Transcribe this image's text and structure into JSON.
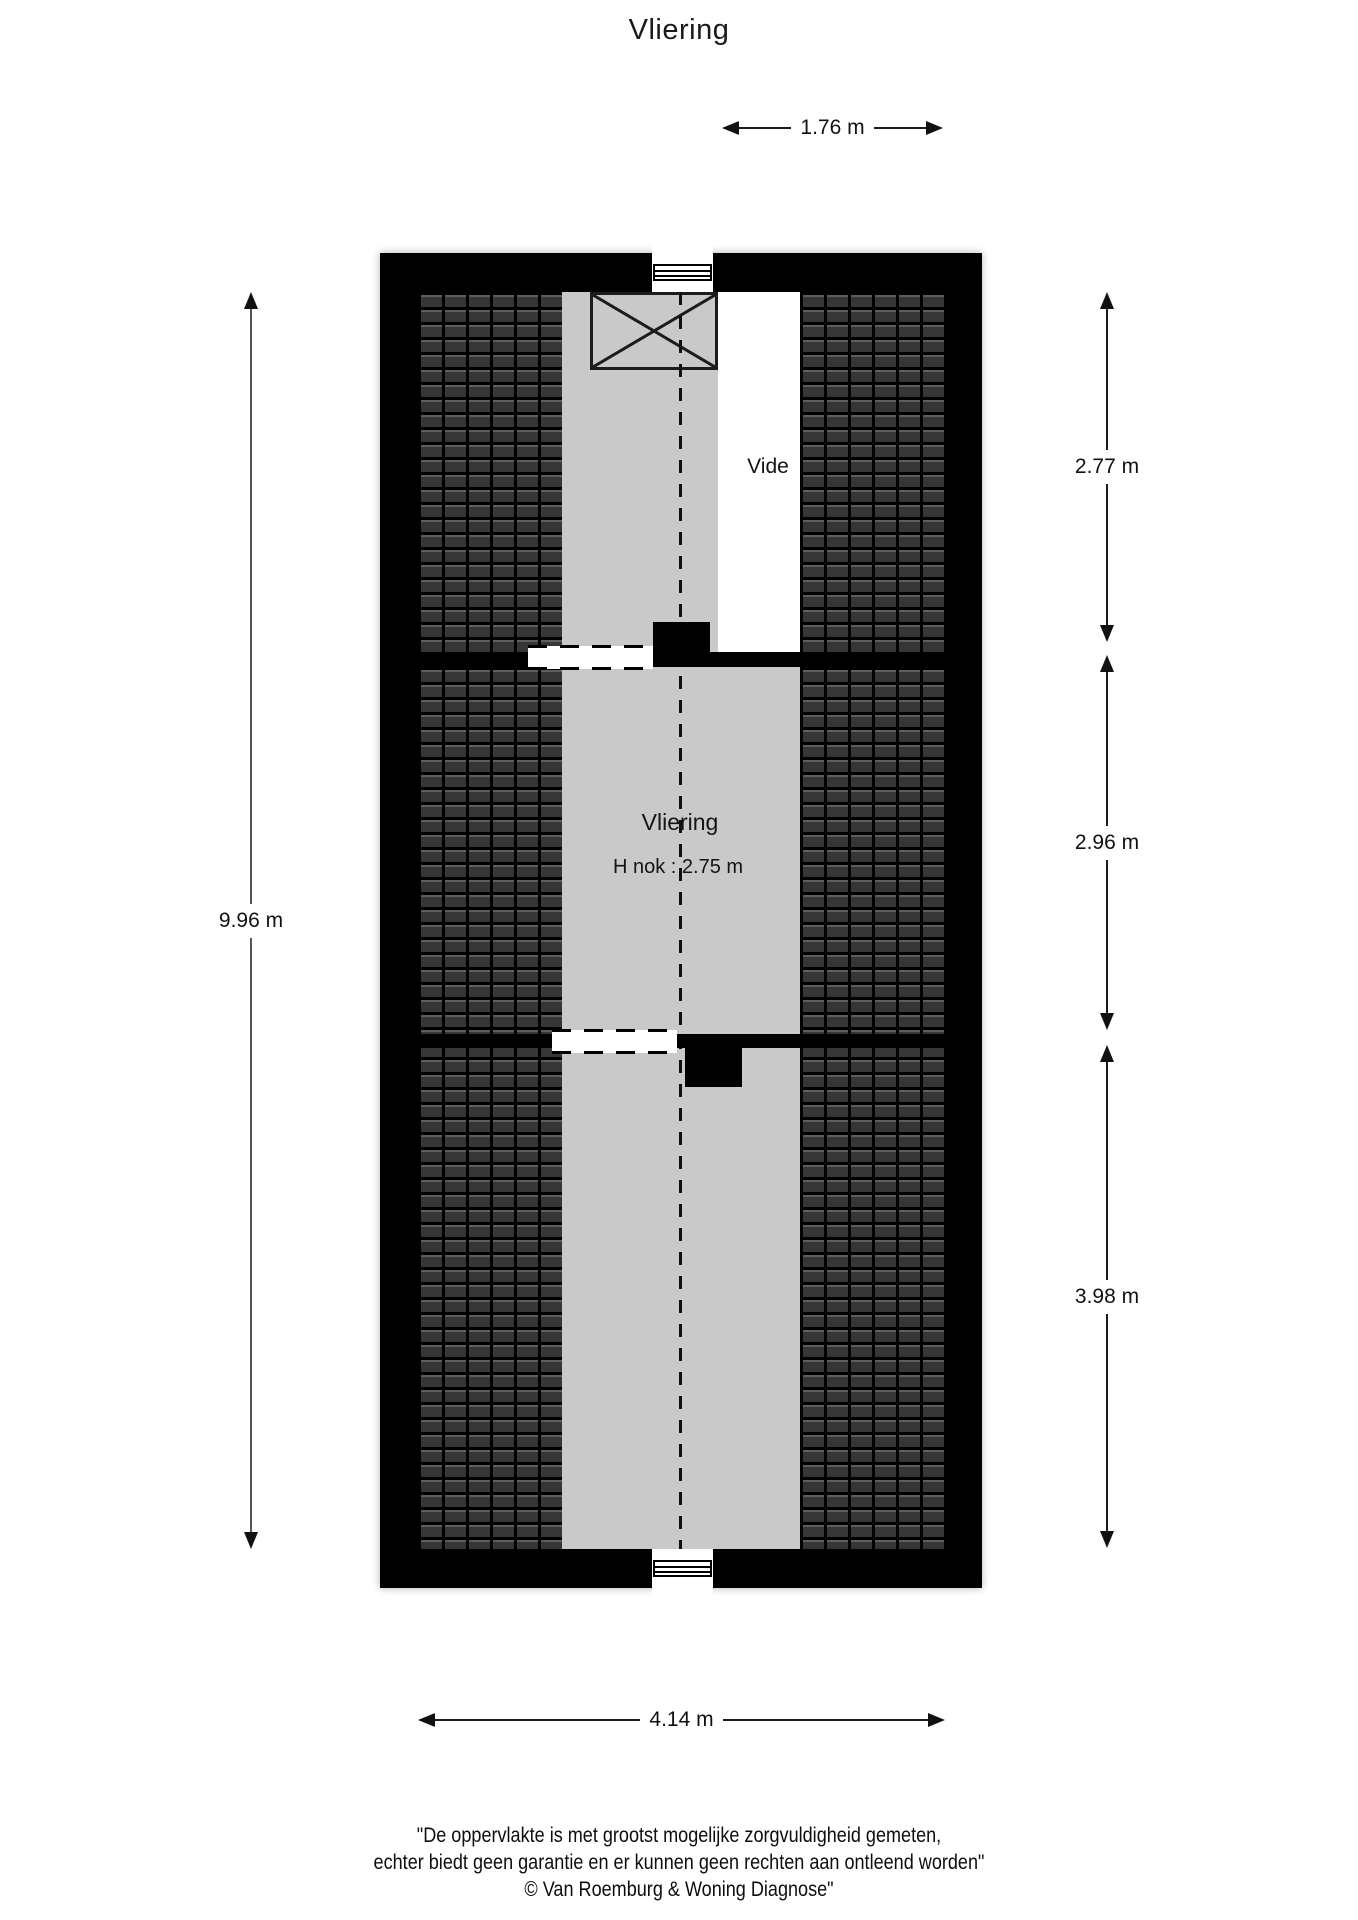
{
  "title": "Vliering",
  "colors": {
    "wall": "#000000",
    "floor": "#c9c9c9",
    "vide": "#ffffff"
  },
  "labels": {
    "vide": "Vide",
    "room": "Vliering",
    "ridge_height": "H nok : 2.75 m"
  },
  "dimensions": {
    "top": "1.76 m",
    "left": "9.96 m",
    "bottom": "4.14 m",
    "right": [
      "2.77 m",
      "2.96 m",
      "3.98 m"
    ]
  },
  "disclaimer": {
    "line1": "\"De oppervlakte is met grootst mogelijke zorgvuldigheid gemeten,",
    "line2": "echter biedt geen garantie en er kunnen geen rechten aan ontleend worden\"",
    "line3": "© Van Roemburg & Woning Diagnose\""
  }
}
